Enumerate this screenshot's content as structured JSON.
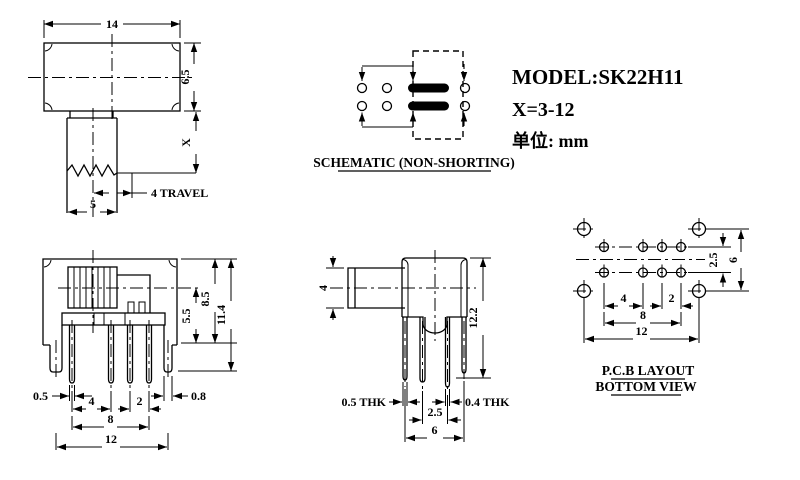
{
  "title_block": {
    "model": "MODEL:SK22H11",
    "x_range": "X=3-12",
    "unit": "单位: mm"
  },
  "schematic": {
    "caption": "SCHEMATIC (NON-SHORTING)"
  },
  "top_view": {
    "dims": {
      "body_width": "14",
      "body_height": "6.5",
      "shaft_height": "X",
      "travel": "4 TRAVEL",
      "knob_width": "5"
    }
  },
  "front_view": {
    "dims": {
      "body_height": "8.5",
      "row_offset": "5.5",
      "total_height": "11.4",
      "pin_thk": "0.5",
      "pitch_a": "4",
      "pitch_b": "2",
      "leg_thk": "0.8",
      "pin_span": "8",
      "leg_span": "12"
    }
  },
  "side_view": {
    "dims": {
      "knob_height": "4",
      "total_height": "12.2",
      "front_thk": "0.5 THK",
      "row_pitch": "2.5",
      "rear_thk": "0.4 THK",
      "depth": "6"
    }
  },
  "pcb_view": {
    "caption_line1": "P.C.B LAYOUT",
    "caption_line2": "BOTTOM VIEW",
    "dims": {
      "row_pitch": "2.5",
      "mount_v": "6",
      "pitch_a": "4",
      "pitch_b": "2",
      "pin_span": "8",
      "mount_span": "12"
    }
  }
}
